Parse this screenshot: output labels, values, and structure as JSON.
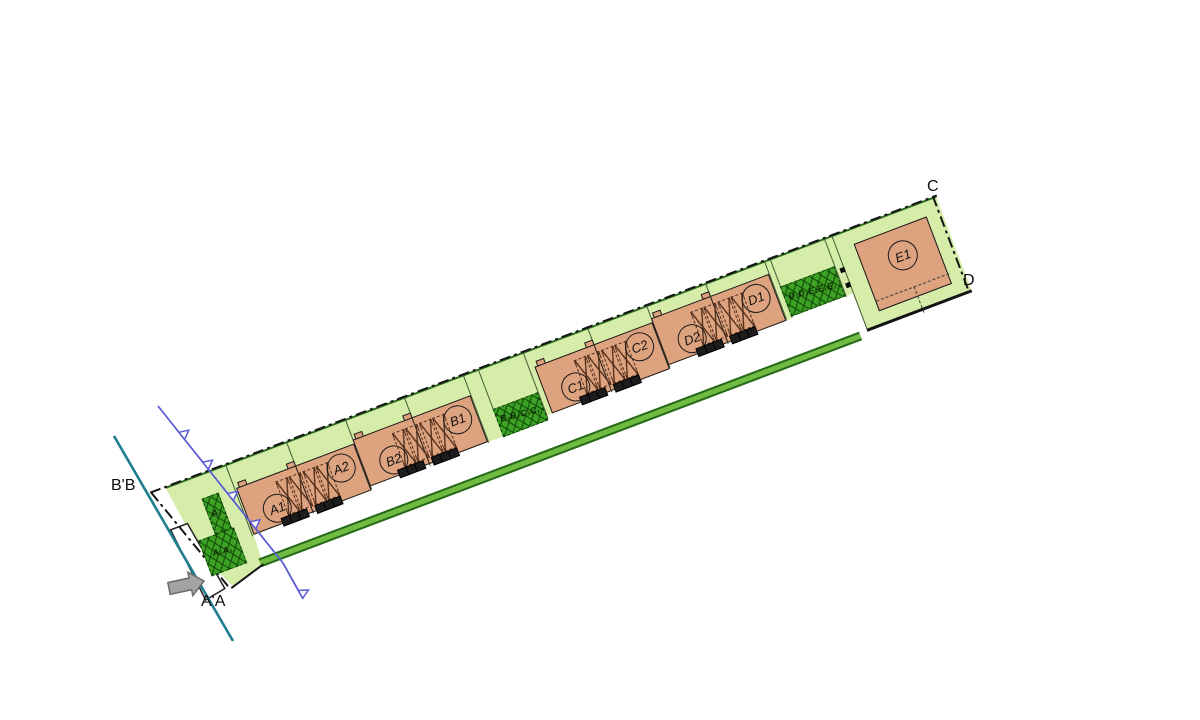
{
  "document_type": "residential site plan drawing",
  "colors": {
    "parcel_green": "#d6edaa",
    "parking_green": "#3da224",
    "building_salmon": "#dda27e",
    "hedge_green": "#70bb42",
    "hedge_edge": "#27691a",
    "boundary_black": "#141414",
    "lot_line": "#3f5d33",
    "section_teal": "#1f7e8f",
    "section_purple": "#5c5cd6",
    "arrow_gray": "#a3a3a3"
  },
  "section_labels": {
    "bb": "B'B",
    "aa": "A'A",
    "c": "C",
    "d": "D"
  },
  "site": {
    "rotation_deg": -20.7,
    "origin": {
      "x": 152,
      "y": 492
    },
    "band_polygon": [
      [
        14,
        0
      ],
      [
        838,
        0
      ],
      [
        838,
        102
      ],
      [
        726,
        102
      ],
      [
        726,
        62
      ],
      [
        718,
        62
      ],
      [
        660,
        62
      ],
      [
        660,
        64
      ],
      [
        528,
        64
      ],
      [
        528,
        68
      ],
      [
        402,
        68
      ],
      [
        396,
        68
      ],
      [
        396,
        73
      ],
      [
        348,
        73
      ],
      [
        348,
        72
      ],
      [
        206,
        72
      ],
      [
        206,
        76
      ],
      [
        80,
        76
      ],
      [
        78,
        108
      ],
      [
        42,
        116
      ],
      [
        25,
        80
      ]
    ],
    "green_top_edge": {
      "x": 14,
      "y": -0.5,
      "len": 824
    },
    "boundary_segments": [
      {
        "type": "dashdot",
        "x": -2,
        "y": -1.5,
        "len": 841,
        "angle": 0,
        "name": "boundary-north"
      },
      {
        "type": "dashdot",
        "x": 836,
        "y": -1,
        "len": 102,
        "angle": 90,
        "name": "boundary-east"
      },
      {
        "type": "dashdot",
        "x": 0,
        "y": 0,
        "len": 125,
        "angle": 71.3,
        "name": "boundary-southwest"
      },
      {
        "type": "solid",
        "x": 726,
        "y": 100,
        "len": 112,
        "angle": 0,
        "thick": 2.6,
        "name": "parcel-south-edge"
      },
      {
        "type": "solid",
        "x": 40,
        "y": 117,
        "len": 40,
        "angle": -16.1,
        "thick": 2.2,
        "name": "boundary-south-access"
      }
    ],
    "lot_lines": [
      [
        78,
        76
      ],
      [
        143,
        76
      ],
      [
        206,
        74
      ],
      [
        269,
        73
      ],
      [
        332,
        72
      ],
      [
        348,
        72
      ],
      [
        396,
        70
      ],
      [
        465,
        68
      ],
      [
        528,
        66
      ],
      [
        591,
        64
      ],
      [
        654,
        62
      ],
      [
        660,
        62
      ],
      [
        718,
        62
      ],
      [
        726,
        102
      ]
    ],
    "hedge": {
      "x": 76,
      "y": 100,
      "w": 642,
      "h": 9
    },
    "notch_points": [
      [
        4,
        42
      ],
      [
        22,
        42
      ],
      [
        34,
        116
      ],
      [
        12,
        120
      ]
    ],
    "blocks": [
      {
        "name": "block-a",
        "x": 80,
        "y": 26,
        "w": 126,
        "h": 50,
        "labels": [
          "A1",
          "A2"
        ]
      },
      {
        "name": "block-b",
        "x": 206,
        "y": 22,
        "w": 126,
        "h": 50,
        "labels": [
          "B2",
          "B1"
        ]
      },
      {
        "name": "block-c",
        "x": 402,
        "y": 18,
        "w": 126,
        "h": 50,
        "labels": [
          "C1",
          "C2"
        ]
      },
      {
        "name": "block-d",
        "x": 528,
        "y": 14,
        "w": 126,
        "h": 50,
        "labels": [
          "D2",
          "D1"
        ]
      }
    ],
    "block_geometry": {
      "party_wall_x": 62,
      "hatch_cell_xs": [
        38,
        52,
        67,
        81
      ],
      "hatch_cell": {
        "y": 7,
        "w": 12.5,
        "h": 36
      },
      "left_label": {
        "x": 16,
        "y": 18
      },
      "right_label": {
        "x": 90,
        "y": 3
      },
      "car_clusters": [
        [
          30,
          39,
          48
        ],
        [
          66,
          75,
          84
        ]
      ],
      "car": {
        "w": 8,
        "h": 7
      },
      "bump_xs": [
        2,
        54
      ],
      "bump": {
        "w": 9,
        "h": 6
      }
    },
    "e1": {
      "building": {
        "x": 744,
        "y": 16,
        "w": 78,
        "h": 72
      },
      "label": "E1",
      "label_pos": {
        "x": 26,
        "y": 12
      },
      "dash_h": {
        "x": 0,
        "y": 60,
        "w": 78
      },
      "dash_v": {
        "x": 40,
        "y": 60,
        "h": 28
      },
      "marks": [
        [
          722,
          34
        ],
        [
          722,
          50
        ]
      ]
    },
    "parking_areas": [
      {
        "label": "A₁",
        "x": 44,
        "y": 24,
        "w": 18,
        "h": 38
      },
      {
        "label": "A₂A₁",
        "x": 26,
        "y": 62,
        "w": 38,
        "h": 38
      },
      {
        "label": "B₁B₂C₂C₁",
        "x": 348,
        "y": 43,
        "w": 48,
        "h": 30
      },
      {
        "label": "D₁D₂E₁E₁E₁",
        "x": 660,
        "y": 30,
        "w": 58,
        "h": 32
      }
    ]
  },
  "overlay": {
    "teal_line": [
      [
        114,
        436
      ],
      [
        233,
        641
      ]
    ],
    "purple_line": {
      "points": [
        [
          158,
          406
        ],
        [
          283,
          563
        ],
        [
          302,
          597
        ]
      ],
      "marker_ts": [
        0.19,
        0.38,
        0.58,
        0.76
      ]
    },
    "arrow_points": [
      [
        204,
        581
      ],
      [
        192.8,
        595.6
      ],
      [
        191.6,
        589.8
      ],
      [
        170.2,
        594.4
      ],
      [
        167.8,
        582.6
      ],
      [
        189.1,
        578
      ],
      [
        187.8,
        572.2
      ]
    ]
  }
}
